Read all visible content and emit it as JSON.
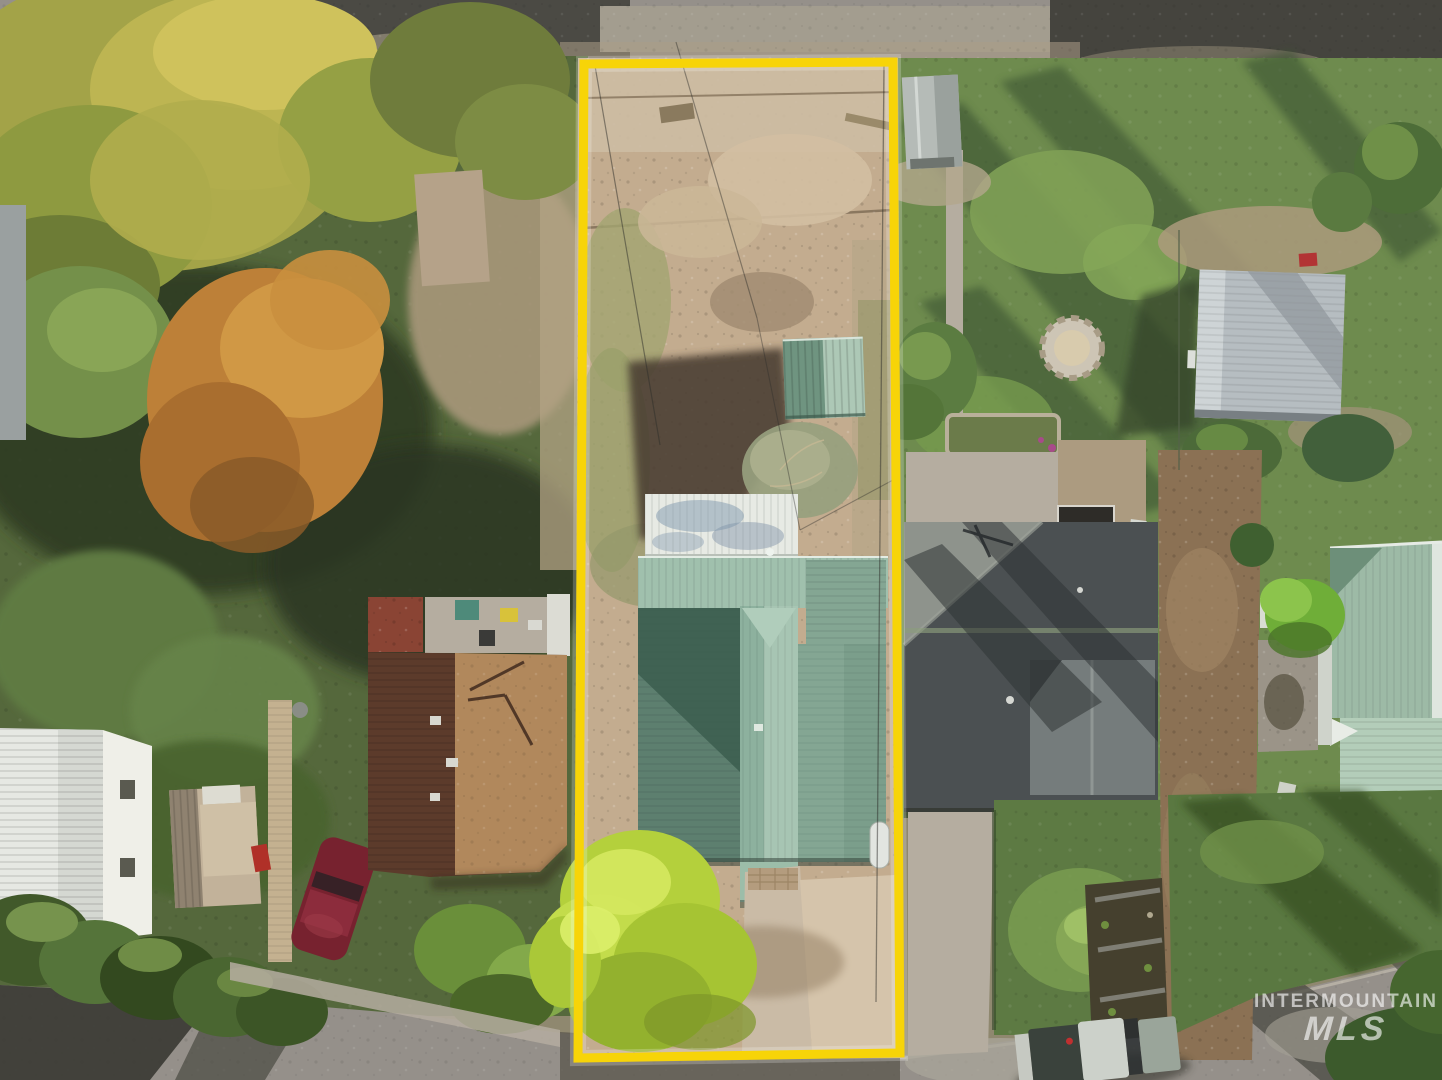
{
  "watermark": {
    "brand_line": "INTERMOUNTAIN",
    "mls_line": "MLS"
  },
  "colors": {
    "boundary-yellow": "#F7D408",
    "dirt-lot": "#C3AC8F",
    "lawn-left": "#55683C",
    "lawn-right": "#6E8B4E",
    "lawn-shadow": "#3A5330",
    "roof-sage-light": "#A0C0AD",
    "roof-sage": "#84A693",
    "roof-sage-dark": "#3D6051",
    "roof-white": "#E7EAE4",
    "shed-green": "#7FA28E",
    "barn-white": "#E6E8E3",
    "garage-gray": "#B6BDC1",
    "roof-charcoal": "#4B5052",
    "roof-brown-dark": "#5C3B2B",
    "roof-brown-lit": "#B1885C",
    "tree-yellow": "#A3A348",
    "tree-orange": "#BD8038",
    "tree-chartreuse": "#B4D03C",
    "road-gravel": "#95908A",
    "road-asphalt": "#4B4A44",
    "concrete": "#B5ADA0",
    "car-maroon": "#77222F",
    "watermark": "#FFFFFF"
  }
}
